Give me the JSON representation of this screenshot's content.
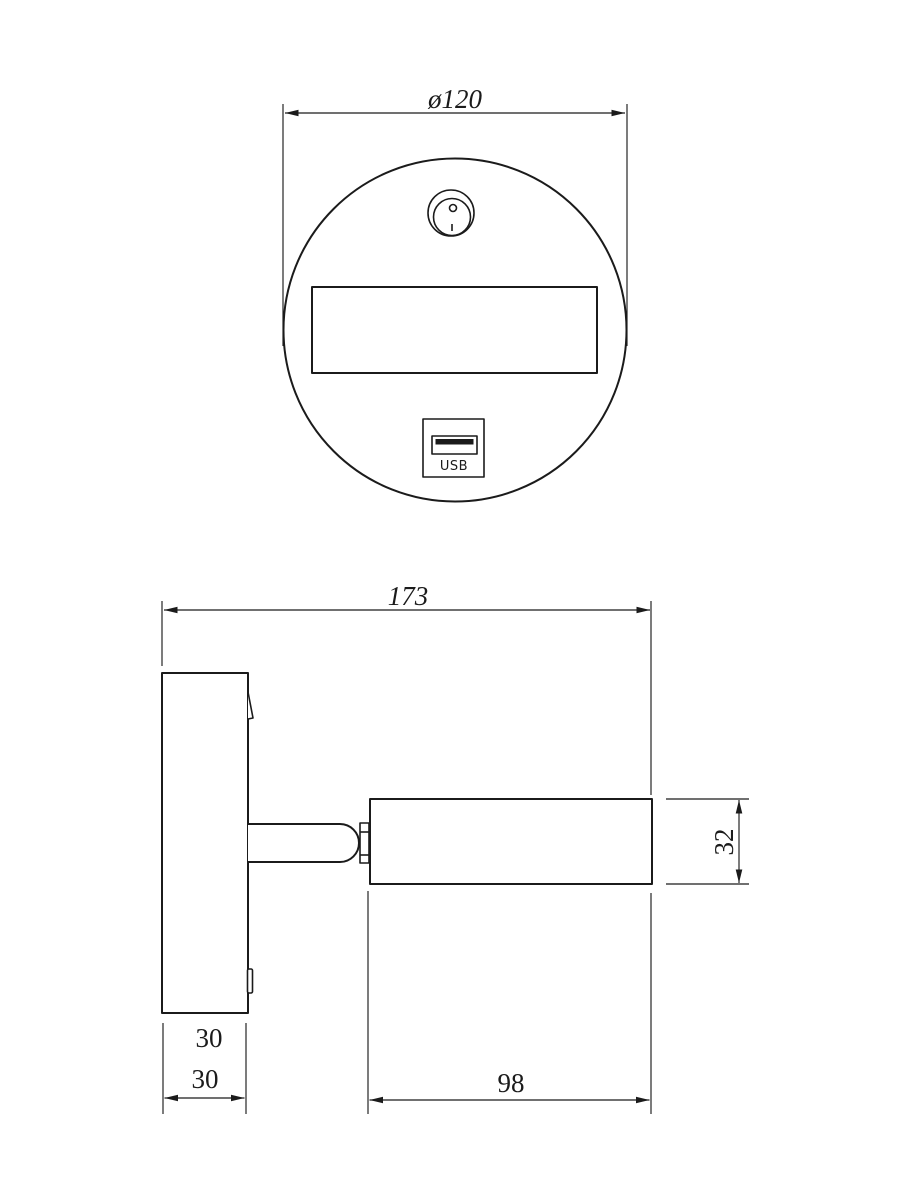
{
  "drawing": {
    "background": "#ffffff",
    "line_color": "#1b1b1b",
    "top_view": {
      "diameter_label": "ø120",
      "usb_label": "USB"
    },
    "side_view": {
      "total_width_label": "173",
      "head_height_label": "32",
      "plate_dim_label_upper": "30",
      "plate_dim_label_lower": "30",
      "head_length_label": "98"
    }
  }
}
